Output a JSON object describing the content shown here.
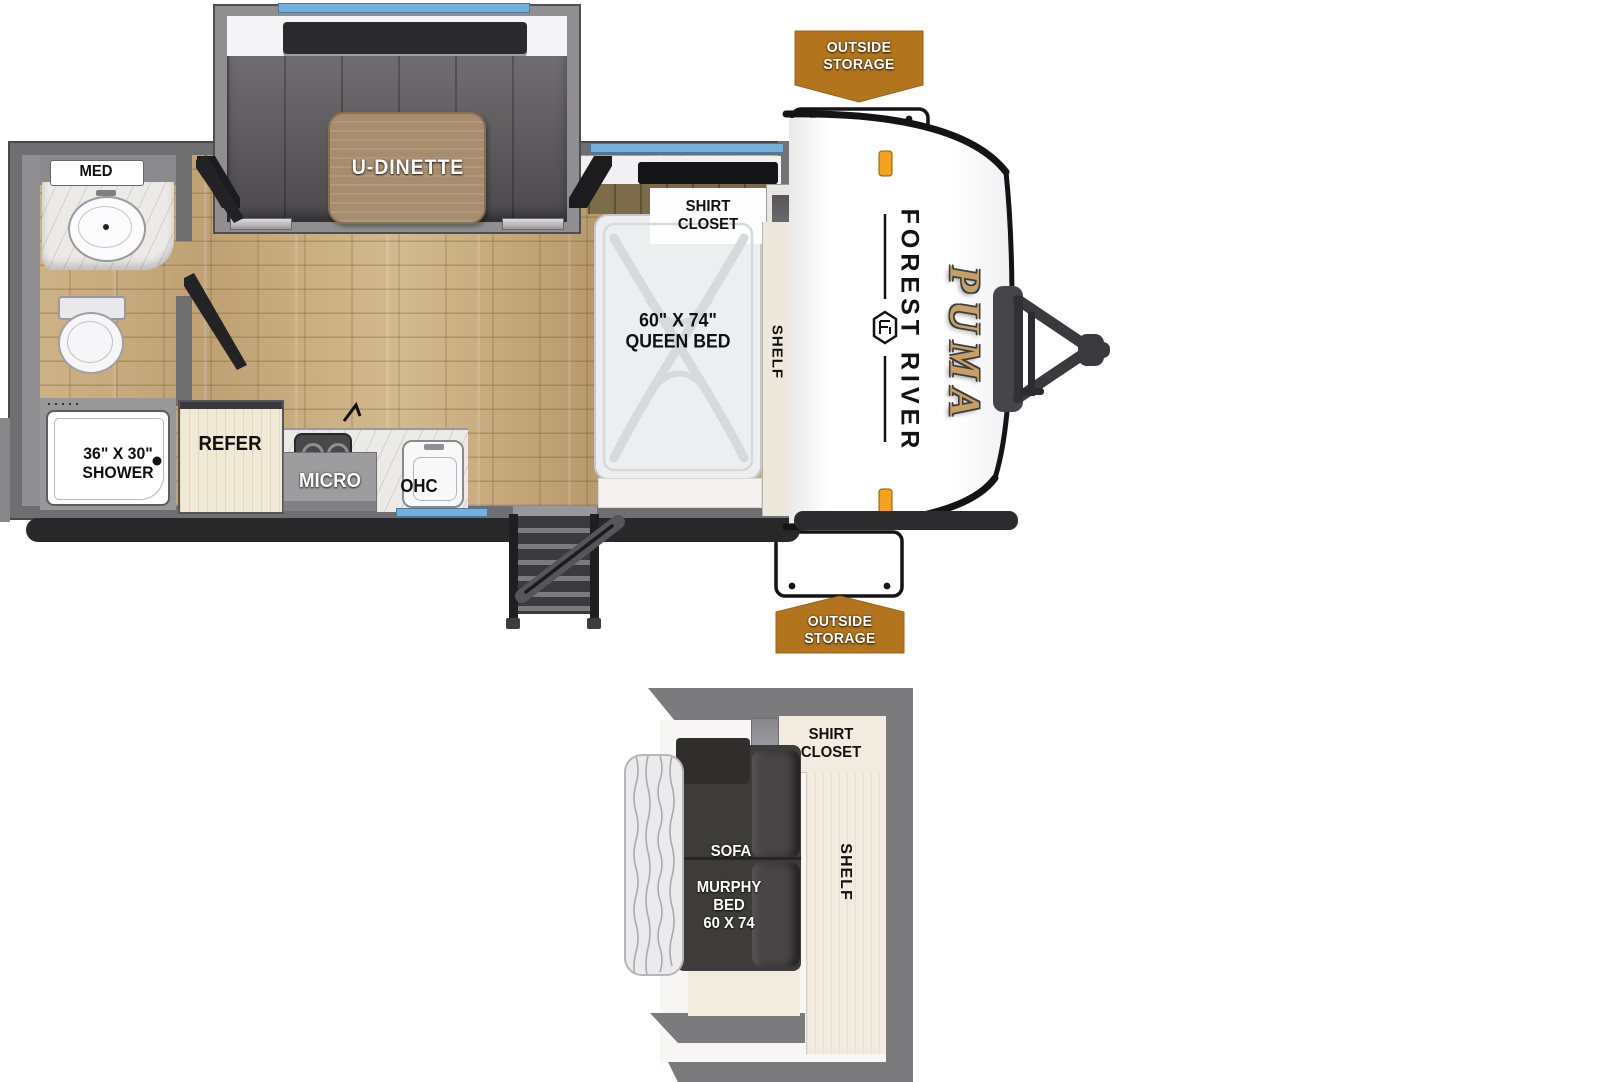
{
  "floorplan": {
    "brand": {
      "manufacturer": "FOREST RIVER",
      "model": "PUMA"
    },
    "callouts": {
      "outside_storage_top": "OUTSIDE\nSTORAGE",
      "outside_storage_bottom": "OUTSIDE\nSTORAGE"
    },
    "bathroom": {
      "med_label": "MED",
      "shower_label": "36\" X 30\"\nSHOWER"
    },
    "galley": {
      "refer_label": "REFER",
      "micro_label": "MICRO",
      "ohc_label": "OHC"
    },
    "dinette": {
      "label": "U-DINETTE"
    },
    "bedroom": {
      "bed_label": "60\" X 74\"\nQUEEN BED",
      "shirt_closet_label": "SHIRT\nCLOSET",
      "shelf_label": "SHELF"
    },
    "inset": {
      "shirt_closet_label": "SHIRT\nCLOSET",
      "sofa_label": "SOFA",
      "murphy_bed_label": "MURPHY\nBED\n60 X 74",
      "shelf_label": "SHELF"
    },
    "colors": {
      "banner_orange": "#b2751d",
      "wall_gray": "#6f6f72",
      "floor_wood": "#c9ad7e",
      "window_blue": "#74b0dc",
      "puma_gold": "#c7a065",
      "marker_amber": "#f6a21c",
      "cushion_charcoal": "#5f5d61",
      "table_wood": "#a78d6d"
    }
  }
}
